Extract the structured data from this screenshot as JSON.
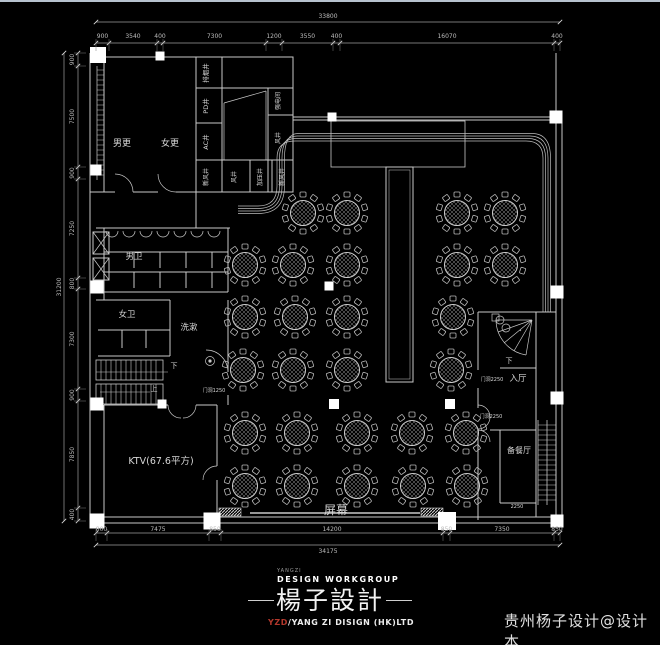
{
  "page": {
    "background": "#000000",
    "line_color": "#c9c9c9",
    "accent_red": "#b3382c",
    "watermark": "贵州杨子设计@设计本"
  },
  "logo": {
    "tiny": "YANGZI",
    "workgroup": "DESIGN WORKGROUP",
    "name_cn": "楊子設計",
    "company_prefix": "YZD",
    "company_rest": "/YANG ZI DISIGN (HK)LTD"
  },
  "floorplan": {
    "labels": [
      {
        "text": "男更",
        "x": 122,
        "y": 146,
        "size": 9,
        "rot": 0
      },
      {
        "text": "女更",
        "x": 170,
        "y": 146,
        "size": 9,
        "rot": 0
      },
      {
        "text": "男卫",
        "x": 134,
        "y": 259,
        "size": 8.5,
        "rot": 0
      },
      {
        "text": "女卫",
        "x": 127,
        "y": 317,
        "size": 8.5,
        "rot": 0
      },
      {
        "text": "洗漱",
        "x": 189,
        "y": 330,
        "size": 8.5,
        "rot": 0
      },
      {
        "text": "KTV(67.6平方)",
        "x": 161,
        "y": 464,
        "size": 9.5,
        "rot": 0
      },
      {
        "text": "屏幕",
        "x": 336,
        "y": 514,
        "size": 12,
        "rot": 0
      },
      {
        "text": "入厅",
        "x": 518,
        "y": 381,
        "size": 8.5,
        "rot": 0
      },
      {
        "text": "备餐厅",
        "x": 519,
        "y": 453,
        "size": 8,
        "rot": 0
      },
      {
        "text": "下",
        "x": 174,
        "y": 368,
        "size": 7,
        "rot": 0
      },
      {
        "text": "上",
        "x": 154,
        "y": 391,
        "size": 7,
        "rot": 0
      },
      {
        "text": "下",
        "x": 509,
        "y": 363,
        "size": 7,
        "rot": 0
      },
      {
        "text": "排烟井",
        "x": 208,
        "y": 73,
        "size": 6.5,
        "rot": -90
      },
      {
        "text": "PD井",
        "x": 208,
        "y": 106,
        "size": 6.5,
        "rot": -90
      },
      {
        "text": "AC井",
        "x": 208,
        "y": 142,
        "size": 6.5,
        "rot": -90
      },
      {
        "text": "新风井",
        "x": 208,
        "y": 177,
        "size": 6,
        "rot": -90
      },
      {
        "text": "风井",
        "x": 236,
        "y": 177,
        "size": 6,
        "rot": -90
      },
      {
        "text": "加压井",
        "x": 262,
        "y": 177,
        "size": 6,
        "rot": -90
      },
      {
        "text": "新风井",
        "x": 284,
        "y": 177,
        "size": 6,
        "rot": -90
      },
      {
        "text": "风井",
        "x": 280,
        "y": 138,
        "size": 6,
        "rot": -90
      },
      {
        "text": "强电间",
        "x": 280,
        "y": 101,
        "size": 6,
        "rot": -90
      },
      {
        "text": "门洞1250",
        "x": 214,
        "y": 392,
        "size": 5,
        "rot": 0
      },
      {
        "text": "门洞2250",
        "x": 492,
        "y": 381,
        "size": 5,
        "rot": 0
      },
      {
        "text": "门洞2250",
        "x": 491,
        "y": 418,
        "size": 5,
        "rot": 0
      },
      {
        "text": "2250",
        "x": 517,
        "y": 508,
        "size": 5,
        "rot": 0
      }
    ],
    "dimensions": {
      "top": {
        "orientation": "h",
        "total": "33800",
        "labels": [
          "900",
          "3540",
          "400",
          "7300",
          "1200",
          "3550",
          "400",
          "16070",
          "400"
        ],
        "boundaries": [
          96,
          109,
          157,
          163,
          266,
          282,
          333,
          340,
          554,
          560
        ],
        "line": 43,
        "text": 38,
        "total_line": 22,
        "total_text": 18
      },
      "bottom": {
        "orientation": "h",
        "total": "34175",
        "labels": [
          "800",
          "7475",
          "850",
          "14200",
          "850",
          "7350",
          "850"
        ],
        "boundaries": [
          96,
          107,
          209,
          221,
          443,
          450,
          554,
          560
        ],
        "line": 533,
        "text": 531,
        "total_line": 545,
        "total_text": 553
      },
      "left": {
        "orientation": "v",
        "total": "31200",
        "labels": [
          "900",
          "7500",
          "900",
          "7250",
          "800",
          "7300",
          "900",
          "7850",
          "400"
        ],
        "boundaries": [
          53,
          66,
          167,
          179,
          278,
          289,
          389,
          401,
          508,
          521
        ],
        "line": 78,
        "text": 74,
        "total_line": 64,
        "total_text": 61
      }
    },
    "tables": [
      [
        303,
        213
      ],
      [
        347,
        213
      ],
      [
        457,
        213
      ],
      [
        505,
        213
      ],
      [
        245,
        265
      ],
      [
        293,
        265
      ],
      [
        347,
        265
      ],
      [
        457,
        265
      ],
      [
        505,
        265
      ],
      [
        245,
        317
      ],
      [
        295,
        317
      ],
      [
        347,
        317
      ],
      [
        453,
        317
      ],
      [
        243,
        370
      ],
      [
        293,
        370
      ],
      [
        347,
        370
      ],
      [
        451,
        370
      ],
      [
        245,
        433
      ],
      [
        297,
        433
      ],
      [
        357,
        433
      ],
      [
        412,
        433
      ],
      [
        466,
        433
      ],
      [
        245,
        486
      ],
      [
        297,
        486
      ],
      [
        357,
        486
      ],
      [
        413,
        486
      ],
      [
        467,
        486
      ]
    ],
    "chairs_per_table": 10,
    "columns": [
      [
        98,
        55,
        16
      ],
      [
        160,
        56,
        9
      ],
      [
        96,
        170,
        11
      ],
      [
        97,
        287,
        13
      ],
      [
        97,
        404,
        13
      ],
      [
        97,
        521,
        15
      ],
      [
        332,
        117,
        9
      ],
      [
        556,
        117,
        13
      ],
      [
        329,
        286,
        9
      ],
      [
        334,
        404,
        10
      ],
      [
        450,
        404,
        10
      ],
      [
        557,
        292,
        13
      ],
      [
        557,
        398,
        13
      ],
      [
        162,
        404,
        9
      ],
      [
        212,
        521,
        17
      ],
      [
        447,
        521,
        18
      ],
      [
        557,
        521,
        13
      ]
    ]
  }
}
